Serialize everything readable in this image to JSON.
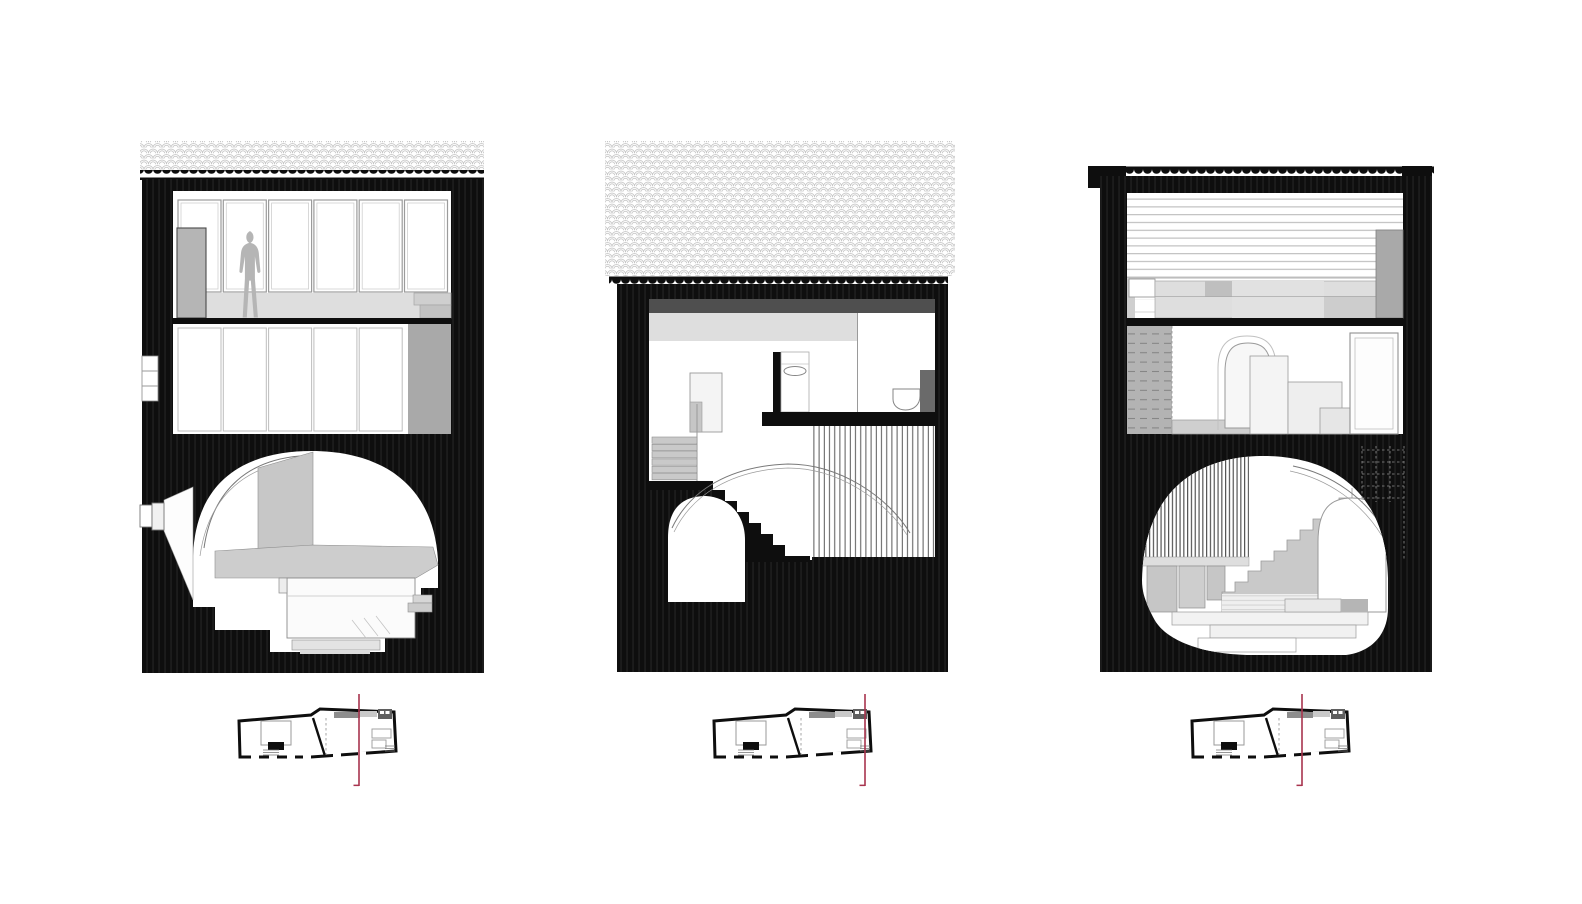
{
  "page": {
    "width": 1582,
    "height": 904,
    "background": "#ffffff"
  },
  "palette": {
    "ink": "#0e0e0e",
    "paper": "#ffffff",
    "tile_line": "#c6c6c6",
    "line_gray": "#9a9a9a",
    "gray_100": "#f2f2f2",
    "gray_200": "#dedede",
    "gray_300": "#c9c9c9",
    "gray_400": "#b5b5b5",
    "gray_500": "#a9a9a9",
    "gray_600": "#6a6a6a",
    "gray_700": "#4f4f4f",
    "accent_red": "#a8344e"
  },
  "sheet": {
    "drawing_count": 3,
    "plan_count": 3
  },
  "sections": [
    {
      "id": "section-1",
      "window_count": 6,
      "features": [
        "tiled-roof",
        "window-wall",
        "human-figure",
        "wardrobe",
        "closet-doors",
        "vaulted-cellar",
        "bed",
        "light-well"
      ]
    },
    {
      "id": "section-2",
      "features": [
        "tall-tiled-roof",
        "bathroom",
        "basin",
        "toilet",
        "stair",
        "arched-door",
        "slatted-screen",
        "vault-arc"
      ]
    },
    {
      "id": "section-3",
      "features": [
        "slatted-wall",
        "cabinetry",
        "hatched-wall",
        "arched-niche",
        "vaulted-cellar",
        "stair",
        "slat-screen",
        "dashed-ladder"
      ]
    }
  ],
  "plans": [
    {
      "id": "plan-1",
      "cut_line_transform": "translate(122,0)"
    },
    {
      "id": "plan-2",
      "cut_line_transform": "translate(153,0)"
    },
    {
      "id": "plan-3",
      "cut_line_transform": "translate(112,0)"
    }
  ]
}
